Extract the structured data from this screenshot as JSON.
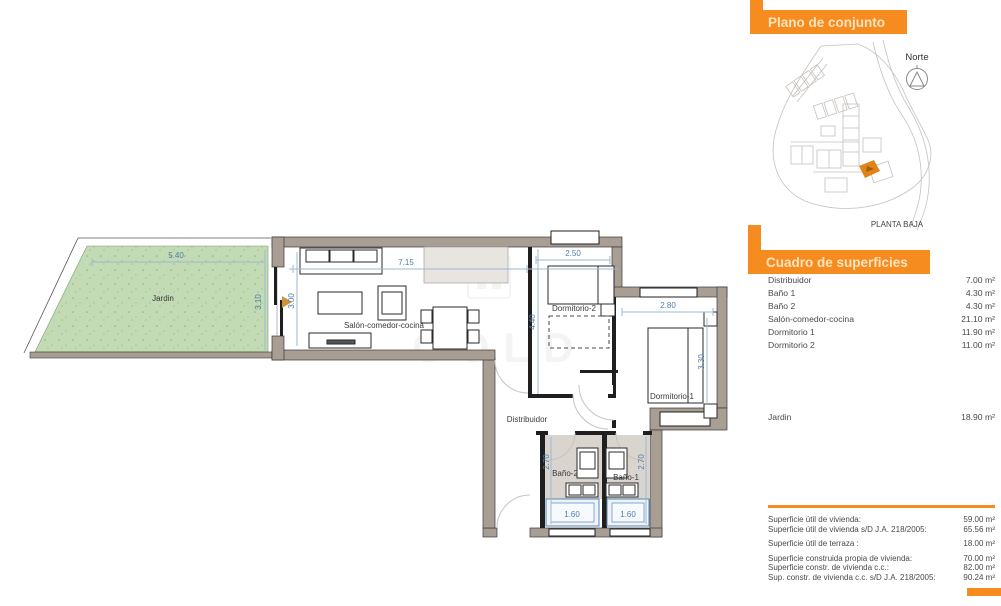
{
  "plan": {
    "labels": {
      "garden": "Jardin",
      "living": "Salón-comedor-cocina",
      "bedroom2": "Dormitorio-2",
      "bedroom1": "Dormitorio-1",
      "hall": "Distribuidor",
      "bath2": "Baño-2",
      "bath1": "Baño-1"
    },
    "dims": {
      "garden_width": "5.40",
      "garden_depth": "3.10",
      "living_width": "7.15",
      "living_depth": "3.00",
      "bedroom2_width": "2.50",
      "bedroom2_depth": "4.40",
      "bedroom1_width": "2.80",
      "bedroom1_depth": "3.30",
      "bath_depth": "2.70",
      "bathtub_width": "1.60"
    },
    "watermark": "COLD"
  },
  "panel": {
    "map_header": "Plano de conjunto",
    "north_label": "Norte",
    "level_label": "PLANTA BAJA",
    "areas_header": "Cuadro de superficies",
    "areas": [
      {
        "label": "Distribuidor",
        "value": "7.00 m²"
      },
      {
        "label": "Baño 1",
        "value": "4.30 m²"
      },
      {
        "label": "Baño 2",
        "value": "4.30 m²"
      },
      {
        "label": "Salón-comedor-cocina",
        "value": "21.10 m²"
      },
      {
        "label": "Dormitorio 1",
        "value": "11.90 m²"
      },
      {
        "label": "Dormitorio 2",
        "value": "11.00 m²"
      }
    ],
    "garden_row": {
      "label": "Jardin",
      "value": "18.90 m²"
    },
    "summary": [
      {
        "label": "Superficie útil de vivienda:",
        "value": "59.00 m²"
      },
      {
        "label": "Superficie útil de vivienda s/D J.A. 218/2005:",
        "value": "65.56 m²"
      },
      {
        "label": "Superficie útil de terraza :",
        "value": "18.00 m²"
      },
      {
        "label": "Superficie construida propia de vivienda:",
        "value": "70.00 m²"
      },
      {
        "label": "Superficie constr. de vivienda c.c.:",
        "value": "82.00 m²"
      },
      {
        "label": "Sup. constr. de vivienda c.c. s/D J.A. 218/2005:",
        "value": "90.24 m²"
      }
    ],
    "colors": {
      "accent": "#f68b1f",
      "dimension_blue": "#4f7dab",
      "wall": "#a89e94",
      "garden_green": "#c3dbb4"
    }
  }
}
